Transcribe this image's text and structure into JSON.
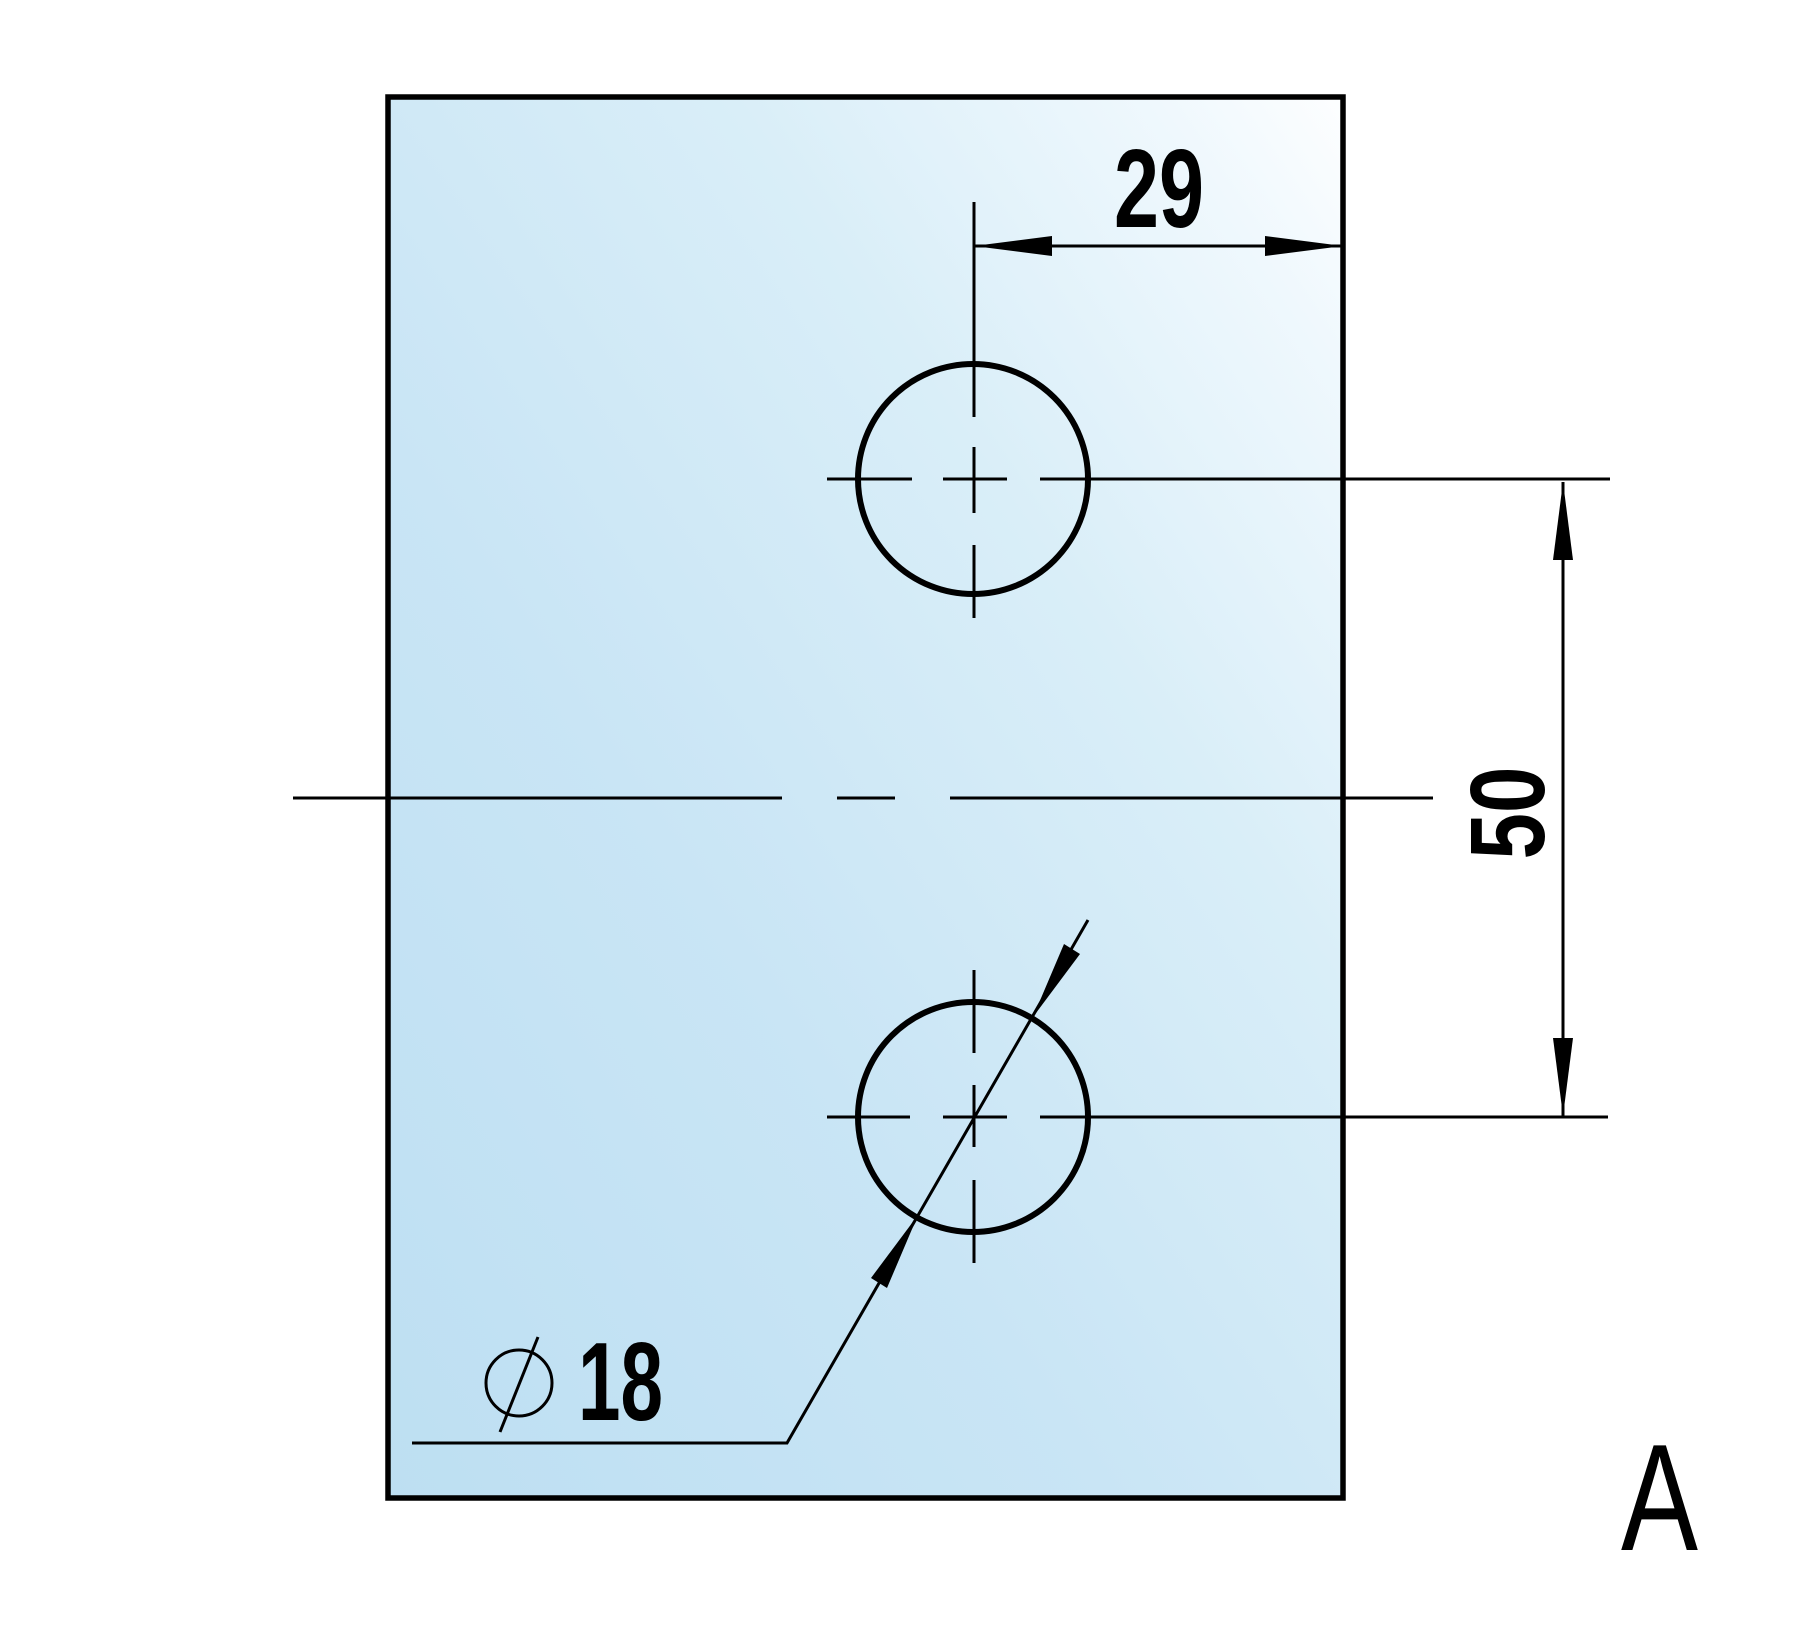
{
  "drawing": {
    "view_label": "A",
    "canvas": {
      "width": 1797,
      "height": 1632,
      "background": "#ffffff"
    },
    "colors": {
      "line": "#000000",
      "hole_fill": "#ffffff",
      "plate_gradient": [
        {
          "offset": "0%",
          "color": "#bddff2"
        },
        {
          "offset": "38%",
          "color": "#c9e5f5"
        },
        {
          "offset": "68%",
          "color": "#d9eef8"
        },
        {
          "offset": "90%",
          "color": "#eff8fd"
        },
        {
          "offset": "100%",
          "color": "#fdfeff"
        }
      ]
    },
    "plate": {
      "x": 388,
      "y": 97,
      "width": 955,
      "height": 1401,
      "stroke": "#000000",
      "stroke_width": 5.5
    },
    "holes": [
      {
        "cx": 973,
        "cy": 479,
        "r": 115,
        "stroke_width": 6
      },
      {
        "cx": 973,
        "cy": 1117,
        "r": 115,
        "stroke_width": 6
      }
    ],
    "centerline_width": 3,
    "centerlines": [
      [
        293,
        798,
        782,
        798
      ],
      [
        837,
        798,
        895,
        798
      ],
      [
        950,
        798,
        1433,
        798
      ],
      [
        974,
        202,
        974,
        417
      ],
      [
        974,
        447,
        974,
        513
      ],
      [
        974,
        545,
        974,
        618
      ],
      [
        827,
        479,
        912,
        479
      ],
      [
        943,
        479,
        1007,
        479
      ],
      [
        1040,
        479,
        1610,
        479
      ],
      [
        974,
        970,
        974,
        1053
      ],
      [
        974,
        1085,
        974,
        1147
      ],
      [
        974,
        1180,
        974,
        1263
      ],
      [
        827,
        1117,
        910,
        1117
      ],
      [
        943,
        1117,
        1007,
        1117
      ],
      [
        1040,
        1117,
        1608,
        1117
      ]
    ],
    "dimension_lines": [
      [
        974,
        246,
        1343,
        246
      ],
      [
        1563,
        482,
        1563,
        1116
      ]
    ],
    "dimension_line_width": 3,
    "leader_polyline": "412,1443 787,1443 1088,920",
    "leader_width": 3,
    "arrowheads": [
      "974,246 1052,236 1052,256",
      "1343,246 1265,236 1265,256",
      "1563,482 1553,560 1573,560",
      "1563,1116 1553,1038 1573,1038",
      "1033,1017 1080,954 1064,944",
      "918,1215 887,1288 871,1278"
    ],
    "diameter_symbol": {
      "cx": 519,
      "cy": 1383,
      "r": 33,
      "stroke_width": 3,
      "slash_x1": 500,
      "slash_y1": 1432,
      "slash_x2": 538,
      "slash_y2": 1337
    },
    "texts": {
      "dim29": {
        "value": "29",
        "x": 1114,
        "y": 227,
        "fs": 111,
        "len": 90,
        "weight": "bold"
      },
      "dim50": {
        "value": "50",
        "transform": "translate(1544,813) rotate(-90)",
        "fs": 106,
        "len": 93,
        "weight": "bold"
      },
      "dia18": {
        "value": "18",
        "x": 578,
        "y": 1420,
        "fs": 111,
        "len": 85,
        "weight": "bold"
      },
      "labelA": {
        "value": "A",
        "x": 1621,
        "y": 1550,
        "fs": 152,
        "len": 77,
        "weight": "normal"
      }
    }
  }
}
